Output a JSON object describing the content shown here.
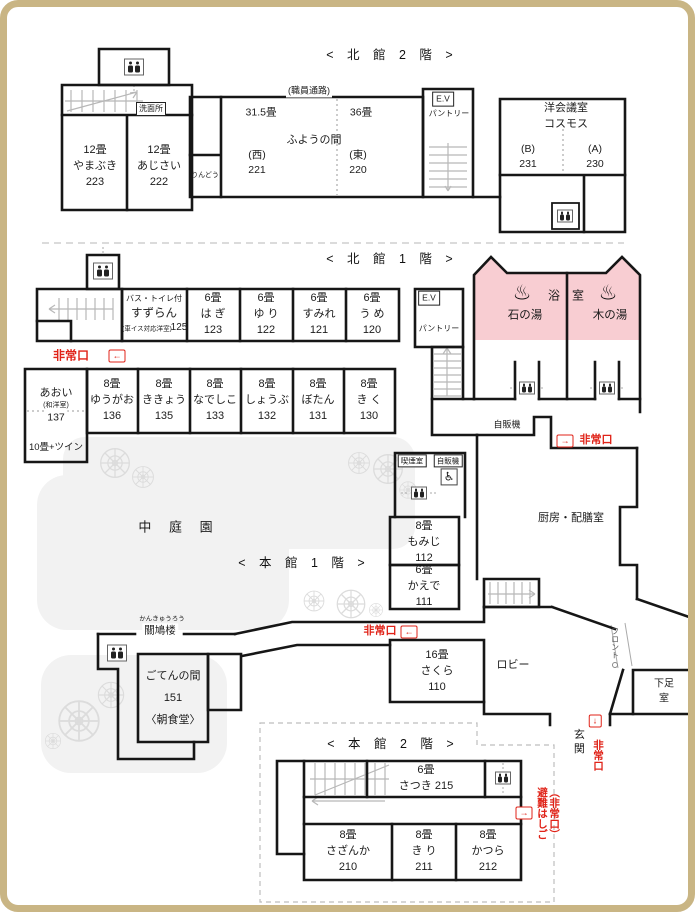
{
  "colors": {
    "accent_red": "#e02318",
    "bath_pink": "#f8cdd2",
    "frame": "#c9b584"
  },
  "icons": {
    "arrow_left": "←",
    "arrow_right": "→",
    "arrow_down": "↓",
    "onsen": "♨",
    "wheelchair": "♿"
  },
  "titles": {
    "north2": "< 北 館 2 階 >",
    "north1": "< 北 館 1 階 >",
    "main1": "< 本 館 1 階 >",
    "main2": "< 本 館 2 階 >"
  },
  "north2": {
    "senmenjo": "洗面所",
    "yamabuki": "12畳\nやまぶき\n223",
    "ajisai": "12畳\nあじさい\n222",
    "staff_corridor": "(職員通路)",
    "rindou": "りんどう",
    "fuyo_west_size": "31.5畳",
    "fuyo_east_size": "36畳",
    "fuyo_name": "ふようの間",
    "fuyo_west": "(西)\n221",
    "fuyo_east": "(東)\n220",
    "ev": "E.V",
    "pantry": "パントリー",
    "conference": "洋会議室\nコスモス",
    "conf_b": "(B)\n231",
    "conf_a": "(A)\n230"
  },
  "north1": {
    "exit": "非常口",
    "suzuran_feature": "バス・トイレ付",
    "suzuran": "すずらん",
    "suzuran_note": "(車イス対応洋室)",
    "suzuran_num": "125",
    "hagi": "6畳\nは ぎ\n123",
    "yuri": "6畳\nゆ り\n122",
    "sumire": "6畳\nすみれ\n121",
    "ume": "6畳\nう め\n120",
    "ev": "E.V",
    "pantry": "パントリー",
    "bath_left_char": "浴",
    "bath_right_char": "室",
    "ishinoyu": "石の湯",
    "kinoyu": "木の湯",
    "aoi": "あおい",
    "aoi_type": "(和洋室)",
    "aoi_num": "137",
    "aoi_extra": "10畳+ツイン",
    "yugao": "8畳\nゆうがお\n136",
    "kikyo": "8畳\nききょう\n135",
    "nadeshiko": "8畳\nなでしこ\n133",
    "shobu": "8畳\nしょうぶ\n132",
    "botan": "8畳\nぼたん\n131",
    "kiku": "8畳\nき く\n130"
  },
  "main1": {
    "courtyard": "中 庭 園",
    "vending": "自販機",
    "vending_small": "自販機",
    "smoking": "喫煙室",
    "exit": "非常口",
    "momiji": "8畳\nもみじ\n112",
    "kaede": "6畳\nかえで\n111",
    "kitchen": "厨房・配膳室",
    "kankyuro_kana": "かんきゅうろう",
    "kankyuro": "關鳩楼",
    "goten": "ごてんの間\n151\n〈朝食堂〉",
    "sakura": "16畳\nさくら\n110",
    "lobby": "ロビー",
    "front": "フロント",
    "getsoku": "下足室",
    "genkan": "玄 関"
  },
  "main2": {
    "satsuki": "6畳\nさつき  215",
    "sazanka": "8畳\nさざんか\n210",
    "kiri": "8畳\nき り\n211",
    "katsura": "8畳\nかつら\n212",
    "hinan": "（非常口）\n避難はしご"
  }
}
